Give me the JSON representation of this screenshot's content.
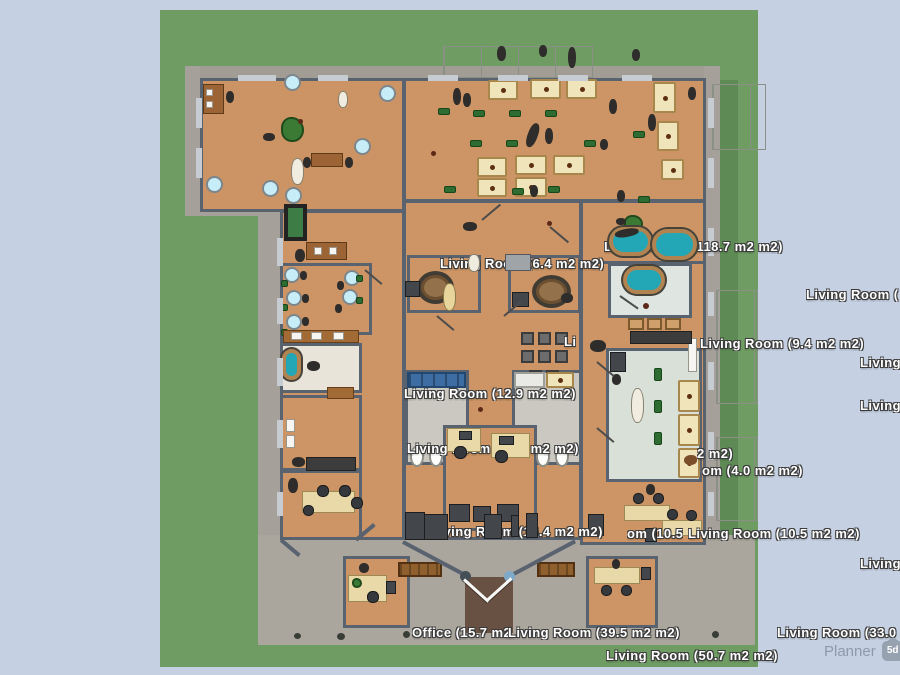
{
  "app": {
    "watermark": {
      "name": "Planner",
      "badge": "5d"
    }
  },
  "scene": {
    "room_labels": [
      {
        "id": "lbl-118",
        "text": "Living Room (118.7 m2 m2)"
      },
      {
        "id": "lbl-64",
        "text": "Living Room (6.4 m2 m2)"
      },
      {
        "id": "lbl-94",
        "text": "Living Room (9.4 m2 m2)"
      },
      {
        "id": "lbl-li",
        "text": "Li"
      },
      {
        "id": "lbl-r1",
        "text": "Living Room ("
      },
      {
        "id": "lbl-r2",
        "text": "Living"
      },
      {
        "id": "lbl-r3",
        "text": "Living"
      },
      {
        "id": "lbl-129",
        "text": "Living Room (12.9 m2 m2)"
      },
      {
        "id": "lbl-101",
        "text": "Living Room (10.1 m2 m2)"
      },
      {
        "id": "lbl-2m2",
        "text": "2 m2)"
      },
      {
        "id": "lbl-40",
        "text": "om (4.0 m2 m2)"
      },
      {
        "id": "lbl-134",
        "text": "Living Room (13.4 m2 m2)"
      },
      {
        "id": "lbl-105a",
        "text": "om (10.5"
      },
      {
        "id": "lbl-105b",
        "text": "Living Room (10.5 m2 m2)"
      },
      {
        "id": "lbl-r4",
        "text": "Living"
      },
      {
        "id": "lbl-office",
        "text": "Office (15.7 m2 m2)"
      },
      {
        "id": "lbl-395",
        "text": "Living Room (39.5 m2 m2)"
      },
      {
        "id": "lbl-330",
        "text": "Living Room (33.0 m2 m2)"
      },
      {
        "id": "lbl-507",
        "text": "Living Room (50.7 m2 m2)"
      }
    ],
    "colors": {
      "terrain_blue": "#c5d0e2",
      "grass": "#6f9c63",
      "sidewalk": "#a5a19a",
      "floor": "#cd9565",
      "wall": "#59626f",
      "water": "#23a7b6"
    }
  }
}
